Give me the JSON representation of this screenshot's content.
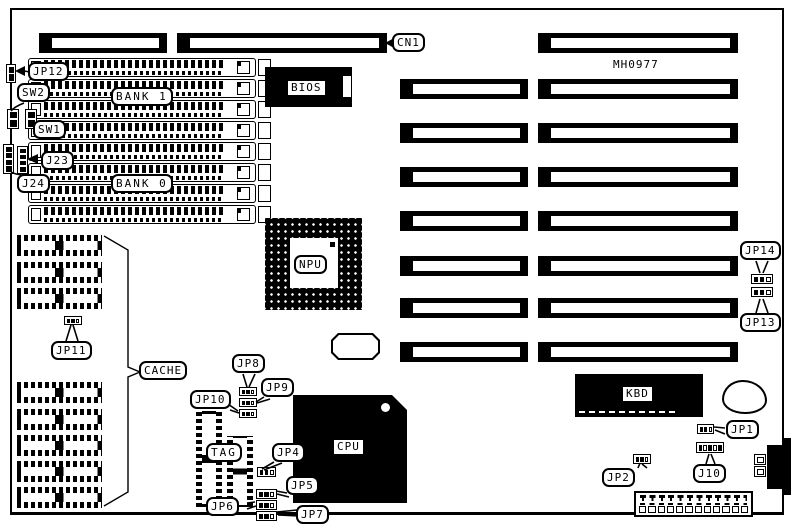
{
  "diagram": {
    "board_id": "MH0977",
    "labels": {
      "cn1": "CN1",
      "jp12": "JP12",
      "sw2": "SW2",
      "sw1": "SW1",
      "j23": "J23",
      "j24": "J24",
      "bank1": "BANK 1",
      "bank0": "BANK 0",
      "bios": "BIOS",
      "npu": "NPU",
      "jp11": "JP11",
      "cache": "CACHE",
      "jp8": "JP8",
      "jp9": "JP9",
      "jp10": "JP10",
      "tag": "TAG",
      "jp4": "JP4",
      "jp5": "JP5",
      "jp6": "JP6",
      "jp7": "JP7",
      "cpu": "CPU",
      "kbd": "KBD",
      "jp14": "JP14",
      "jp13": "JP13",
      "jp1": "JP1",
      "jp2": "JP2",
      "j10": "J10"
    },
    "colors": {
      "ink": "#000000",
      "paper": "#ffffff"
    }
  }
}
